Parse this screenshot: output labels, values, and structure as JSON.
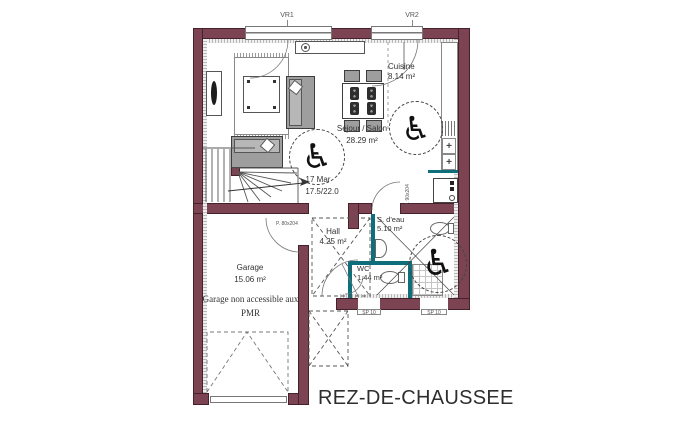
{
  "title": "REZ-DE-CHAUSSEE",
  "windows": {
    "vr1": "VR1",
    "vr2": "VR2"
  },
  "rooms": {
    "sejour": {
      "name": "Séjour / Salon",
      "area": "28.29 m²"
    },
    "cuisine": {
      "name": "Cuisine",
      "area": "8.14 m²"
    },
    "hall": {
      "name": "Hall",
      "area": "4.25 m²"
    },
    "sdeau": {
      "name": "S. d'eau",
      "area": "5.10 m²"
    },
    "wc": {
      "name": "WC",
      "area": "1.44 m²"
    },
    "garage": {
      "name": "Garage",
      "area": "15.06 m²",
      "note": "Garage non accessible aux PMR"
    }
  },
  "stairs": {
    "count_label": "17 Mar",
    "riser_tread": "17.5/22.0"
  },
  "openings": {
    "sp10_left": "SP 10",
    "sp10_right": "SP 10",
    "hall_door": "P. 80x204",
    "sdeau_door": "P. 90x204"
  },
  "symbols": {
    "wheelchair": "♿",
    "burner": "+"
  },
  "colors": {
    "wall": "#7c4452",
    "wall_border": "#45222b",
    "wet_wall": "#0e6e7a",
    "line": "#555555"
  }
}
